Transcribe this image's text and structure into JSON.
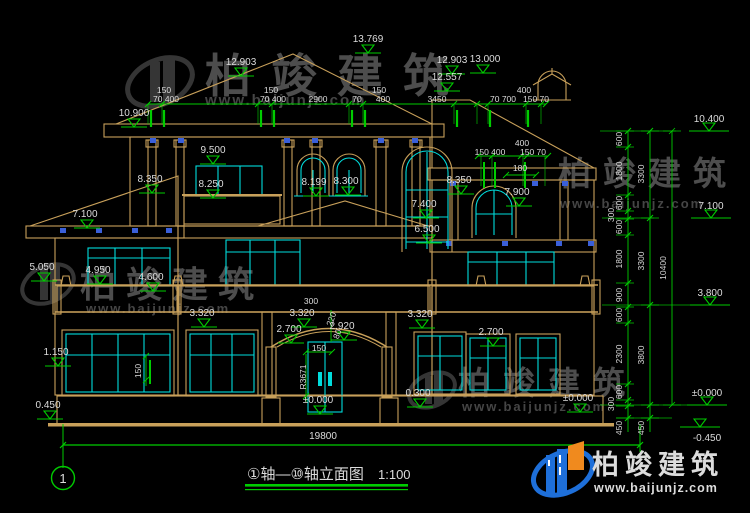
{
  "drawing": {
    "title": "①轴—⑩轴立面图",
    "scale": "1:100",
    "axis_bubble": "1",
    "ground_width": "19800"
  },
  "levels": [
    {
      "value": "13.769"
    },
    {
      "value": "12.903"
    },
    {
      "value": "12.557"
    },
    {
      "value": "12.903"
    },
    {
      "value": "13.000"
    },
    {
      "value": "10.900"
    },
    {
      "value": "9.500"
    },
    {
      "value": "8.350"
    },
    {
      "value": "8.250"
    },
    {
      "value": "8.199"
    },
    {
      "value": "8.300"
    },
    {
      "value": "8.350"
    },
    {
      "value": "7.900"
    },
    {
      "value": "7.100"
    },
    {
      "value": "7.400"
    },
    {
      "value": "6.500"
    },
    {
      "value": "5.050"
    },
    {
      "value": "4.950"
    },
    {
      "value": "4.600"
    },
    {
      "value": "3.320"
    },
    {
      "value": "3.320"
    },
    {
      "value": "3.320"
    },
    {
      "value": "2.700"
    },
    {
      "value": "2.920"
    },
    {
      "value": "2.700"
    },
    {
      "value": "1.150"
    },
    {
      "value": "0.450"
    },
    {
      "value": "0.300"
    },
    {
      "value": "±0.000"
    },
    {
      "value": "±0.000"
    },
    {
      "value": "10.400"
    },
    {
      "value": "7.100"
    },
    {
      "value": "3.800"
    },
    {
      "value": "±0.000"
    },
    {
      "value": "-0.450"
    }
  ],
  "top_dims": [
    {
      "value": "150"
    },
    {
      "value": "70 400"
    },
    {
      "value": "150"
    },
    {
      "value": "70 400"
    },
    {
      "value": "2900"
    },
    {
      "value": "70"
    },
    {
      "value": "150"
    },
    {
      "value": "400"
    },
    {
      "value": "3450"
    },
    {
      "value": "400"
    },
    {
      "value": "70 700"
    },
    {
      "value": "150 70"
    }
  ],
  "upper_right_dims": [
    {
      "value": "400"
    },
    {
      "value": "150 400"
    },
    {
      "value": "150 70"
    },
    {
      "value": "180"
    }
  ],
  "detail_dims": {
    "d300": "300",
    "d150_entry": "150",
    "radius": "R3671",
    "d220": "220",
    "d80": "80",
    "d150_left": "150"
  },
  "right_chain": {
    "col1": [
      {
        "value": "600"
      },
      {
        "value": "1800"
      },
      {
        "value": "600"
      },
      {
        "value": "300"
      },
      {
        "value": "600"
      },
      {
        "value": "1800"
      },
      {
        "value": "900"
      },
      {
        "value": "600"
      },
      {
        "value": "2300"
      },
      {
        "value": "600"
      },
      {
        "value": "300"
      },
      {
        "value": "450"
      }
    ],
    "col2": [
      {
        "value": "3300"
      },
      {
        "value": "3300"
      },
      {
        "value": "3800"
      },
      {
        "value": "450"
      }
    ],
    "col3": [
      {
        "value": "10400"
      }
    ]
  },
  "watermark": {
    "brand": "柏竣建筑",
    "site": "www.baijunjz.com"
  },
  "logo": {
    "brand": "柏竣建筑",
    "site": "www.baijunjz.com"
  },
  "colors": {
    "line": "#C8A05A",
    "window": "#00DCDC",
    "dimension": "#00CC00",
    "balustrade": "#3A5FD9",
    "logo_blue": "#1E6FD9",
    "logo_orange": "#F08A1E",
    "background": "#000000"
  }
}
